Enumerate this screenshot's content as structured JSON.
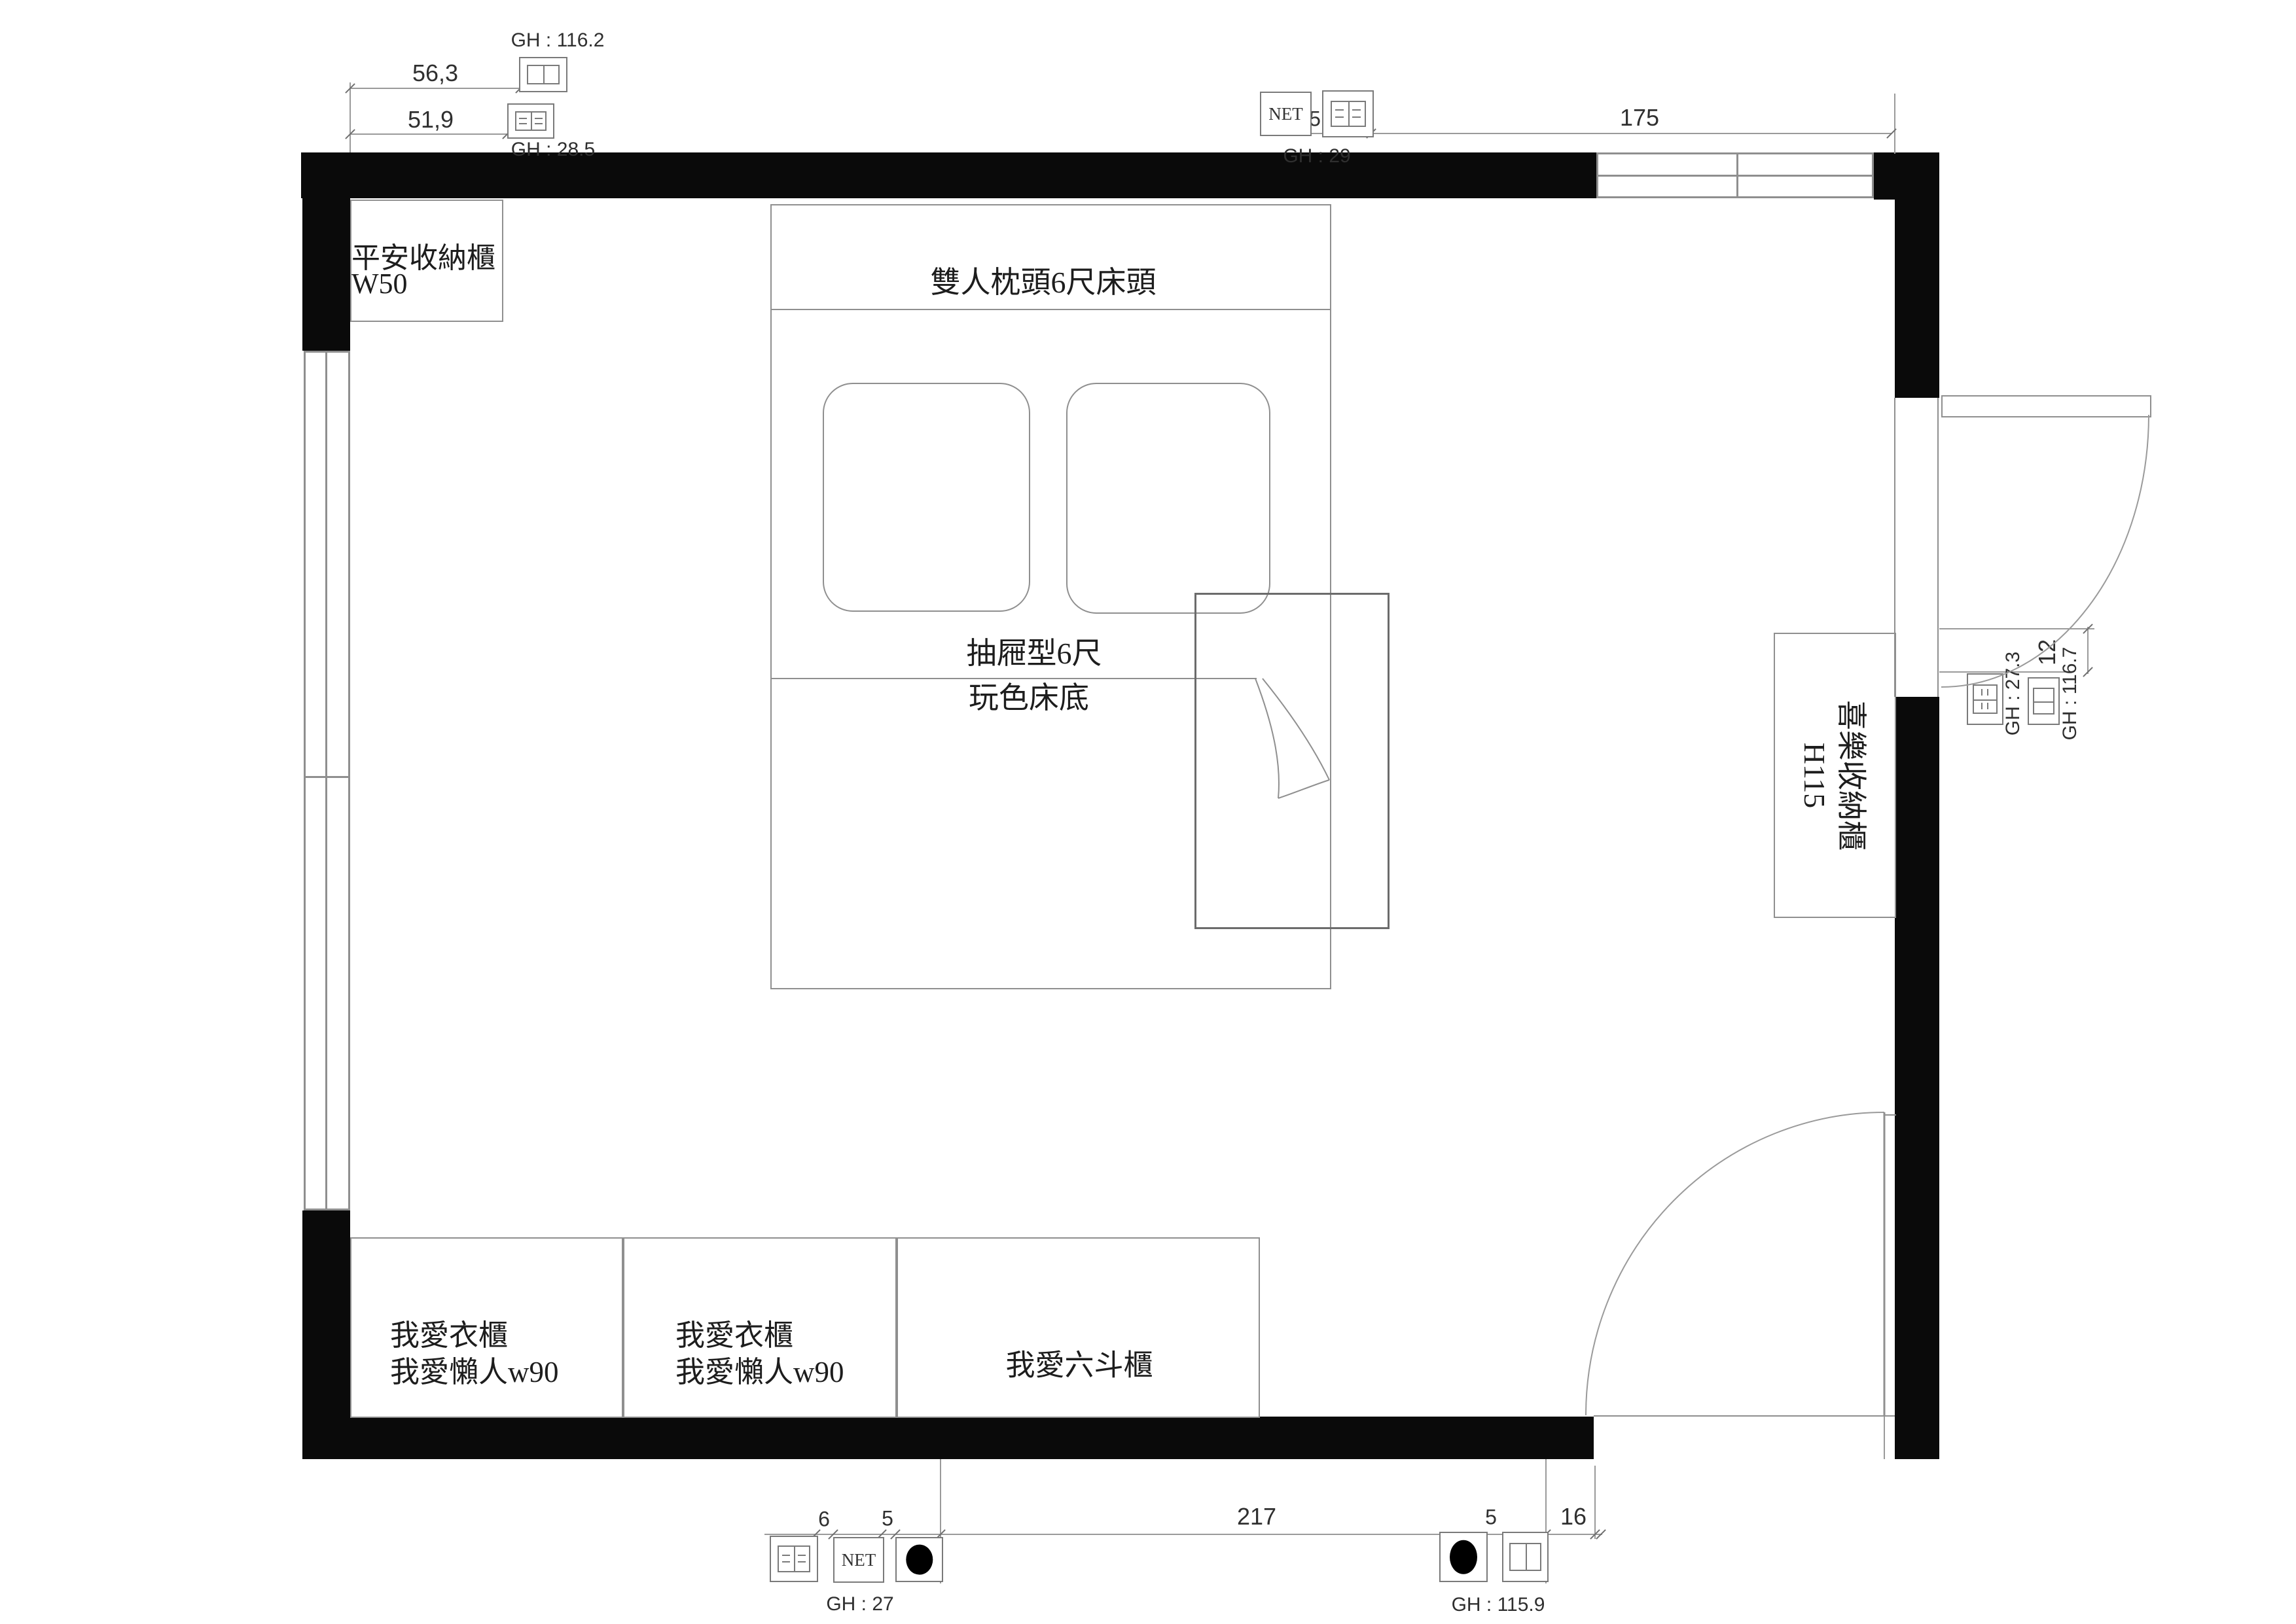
{
  "colors": {
    "wall": "#0a0a0a",
    "line": "#8f8f8f",
    "dim_line": "#9a9a9a",
    "text": "#1f1f1f"
  },
  "furniture": {
    "top_left_cabinet": {
      "name": "平安收納櫃",
      "size": "W50"
    },
    "bed": {
      "headboard": "雙人枕頭6尺床頭",
      "base_line1": "抽屜型6尺",
      "base_line2": "玩色床底"
    },
    "right_cabinet": {
      "name": "喜樂收納櫃",
      "size": "H115"
    },
    "wardrobe_1": {
      "line1": "我愛衣櫃",
      "line2": "我愛懶人w90"
    },
    "wardrobe_2": {
      "line1": "我愛衣櫃",
      "line2": "我愛懶人w90"
    },
    "dresser": {
      "label": "我愛六斗櫃"
    }
  },
  "dimensions": {
    "top_left_upper": "56,3",
    "top_left_lower": "51,9",
    "top_right_gap": "5",
    "top_right_width": "175",
    "right_gap": "12",
    "bottom_left_a": "6",
    "bottom_left_b": "5",
    "bottom_span": "217",
    "bottom_right_a": "5",
    "bottom_right_b": "16"
  },
  "annotations": {
    "gh_116_2": "GH : 116.2",
    "gh_28_5": "GH : 28.5",
    "gh_29": "GH : 29",
    "gh_27_3": "GH : 27.3",
    "gh_116_7": "GH : 116.7",
    "gh_27": "GH : 27",
    "gh_115_9": "GH : 115.9",
    "net": "NET"
  },
  "icons": {
    "outlet_duplex": "power-outlet-duplex-icon",
    "outlet_data": "data-socket-icon",
    "net_port": "net-port-box-icon",
    "light_point": "light-point-icon",
    "window": "window-symbol",
    "door": "door-swing-symbol"
  }
}
